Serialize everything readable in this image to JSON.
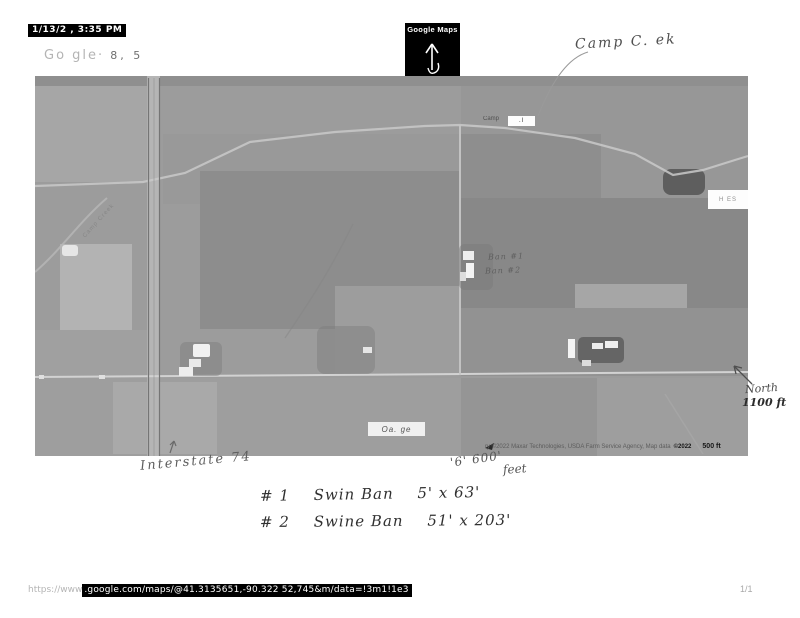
{
  "page": {
    "timestamp": "1/13/2 , 3:35 PM",
    "header_faint": "Go gle·",
    "header_faint2": "8, 5",
    "page_indicator": "1/1"
  },
  "maps_badge": {
    "title": "Google Maps"
  },
  "map": {
    "camp_label": "Camp",
    "camp_box_text": ".l",
    "hes_label": "H ES",
    "village_label": "Oa. ge",
    "creek_road_label": "Camp Creek",
    "attribution": "ry ©2022 Maxar Technologies, USDA Farm Service Agency, Map data",
    "attribution_year": "©2022",
    "scale_label": "500 ft"
  },
  "handwriting": {
    "camp_creek": "Camp C. ek",
    "barn1": "Ban #1",
    "barn2": "Ban #2",
    "interstate": "Interstate 74",
    "measure": "'6' 600'",
    "measure_unit": "feet",
    "north_word": "North",
    "north_distance": "1100 ft",
    "note1_num": "# 1",
    "note1_text": "Swin Ban",
    "note1_dims": "5' x 63'",
    "note2_num": "# 2",
    "note2_text": "Swine Ban",
    "note2_dims": "51' x 203'"
  },
  "url_bar": {
    "prefix": "https://www",
    "url": ".google.com/maps/@41.3135651,-90.322 52,745&m/data=!3m1!1e3"
  },
  "colors": {
    "photo_base": "#9c9c9c",
    "stamp_bg": "#000000"
  }
}
